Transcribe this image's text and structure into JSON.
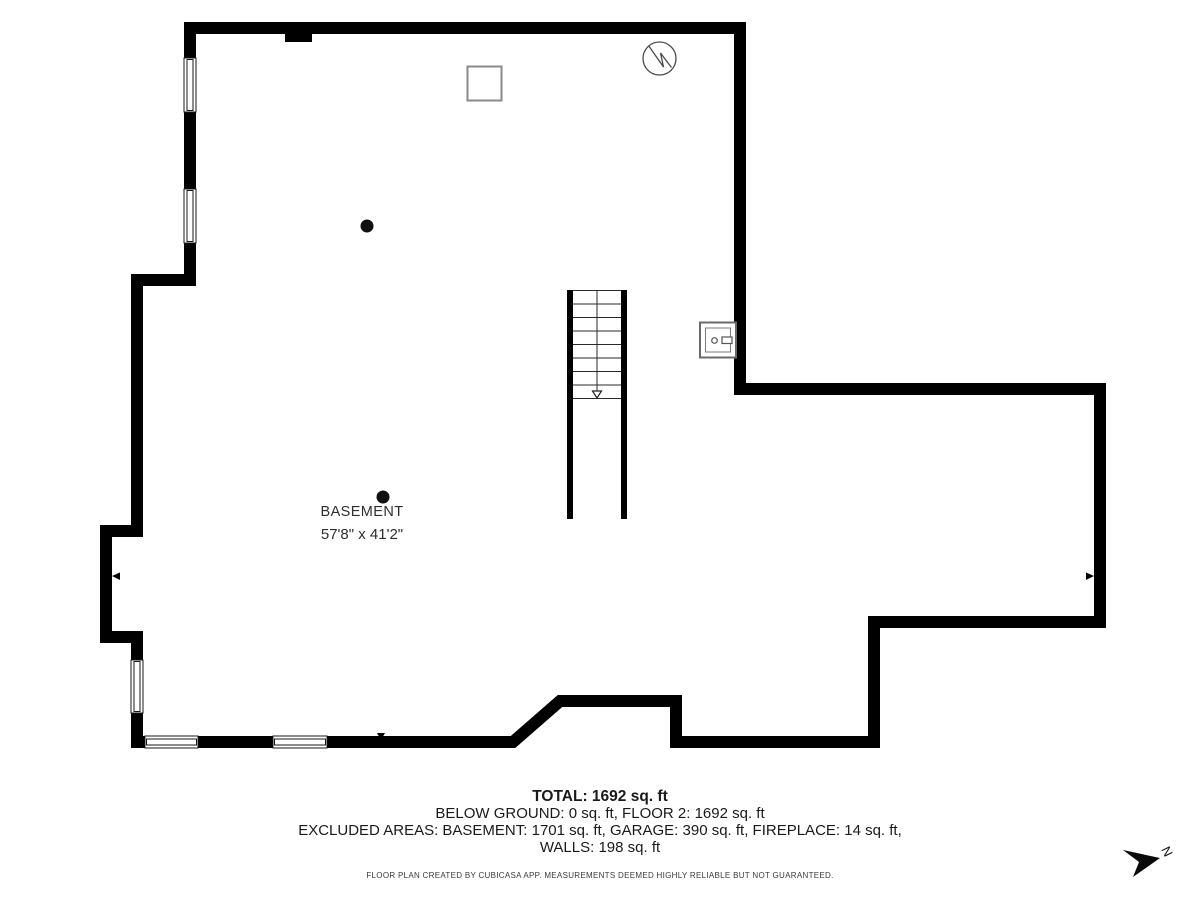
{
  "floor_plan": {
    "room_label": "BASEMENT",
    "room_dimensions": "57'8\" x 41'2\"",
    "north_label": "N"
  },
  "summary": {
    "total": "TOTAL: 1692 sq. ft",
    "below_ground": "BELOW GROUND: 0 sq. ft, FLOOR 2: 1692 sq. ft",
    "excluded_areas": "EXCLUDED AREAS: BASEMENT: 1701 sq. ft, GARAGE: 390 sq. ft, FIREPLACE: 14 sq. ft,",
    "walls": "WALLS: 198 sq. ft",
    "disclaimer": "FLOOR PLAN CREATED BY CUBICASA APP. MEASUREMENTS DEEMED HIGHLY RELIABLE BUT NOT GUARANTEED."
  },
  "colors": {
    "wall": "#000000",
    "symbol_stroke": "#555555",
    "square_stroke": "#8a8a8a",
    "text": "#1a1a1a",
    "background": "#ffffff"
  }
}
